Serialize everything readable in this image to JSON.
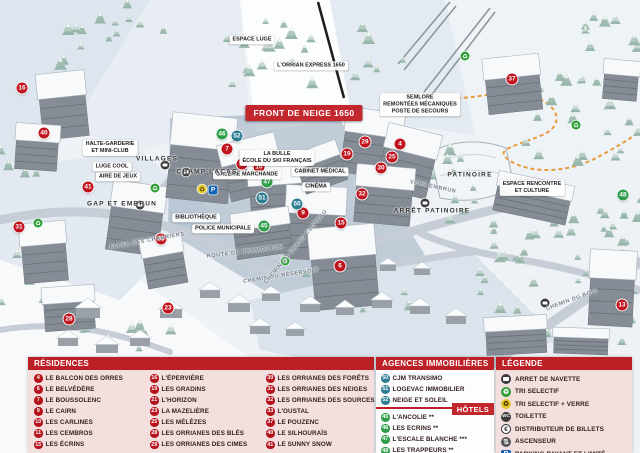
{
  "colors": {
    "header_red": "#bc1f26",
    "banner_red": "#c1272d",
    "residence_marker": "#c0151f",
    "hotel_marker": "#2f9e4a",
    "agency_marker": "#2e7d92",
    "panel_pink": "#f4dfdf"
  },
  "map": {
    "markers": [
      {
        "n": "16",
        "type": "residence",
        "x": 22,
        "y": 88
      },
      {
        "n": "40",
        "type": "residence",
        "x": 44,
        "y": 133
      },
      {
        "n": "31",
        "type": "residence",
        "x": 19,
        "y": 227
      },
      {
        "n": "41",
        "type": "residence",
        "x": 88,
        "y": 187
      },
      {
        "n": "33",
        "type": "residence",
        "x": 161,
        "y": 239
      },
      {
        "n": "28",
        "type": "residence",
        "x": 69,
        "y": 319
      },
      {
        "n": "23",
        "type": "residence",
        "x": 168,
        "y": 308
      },
      {
        "n": "7",
        "type": "residence",
        "x": 227,
        "y": 149
      },
      {
        "n": "11",
        "type": "residence",
        "x": 242,
        "y": 164
      },
      {
        "n": "10",
        "type": "residence",
        "x": 259,
        "y": 167
      },
      {
        "n": "19",
        "type": "residence",
        "x": 347,
        "y": 154
      },
      {
        "n": "9",
        "type": "residence",
        "x": 303,
        "y": 213
      },
      {
        "n": "15",
        "type": "residence",
        "x": 341,
        "y": 223
      },
      {
        "n": "6",
        "type": "residence",
        "x": 340,
        "y": 266
      },
      {
        "n": "29",
        "type": "residence",
        "x": 365,
        "y": 142
      },
      {
        "n": "4",
        "type": "residence",
        "x": 400,
        "y": 144
      },
      {
        "n": "25",
        "type": "residence",
        "x": 392,
        "y": 157
      },
      {
        "n": "30",
        "type": "residence",
        "x": 381,
        "y": 168
      },
      {
        "n": "32",
        "type": "residence",
        "x": 362,
        "y": 194
      },
      {
        "n": "37",
        "type": "residence",
        "x": 512,
        "y": 79
      },
      {
        "n": "13",
        "type": "residence",
        "x": 622,
        "y": 305
      },
      {
        "n": "46",
        "type": "hotel",
        "x": 222,
        "y": 134
      },
      {
        "n": "47",
        "type": "hotel",
        "x": 267,
        "y": 182
      },
      {
        "n": "45",
        "type": "hotel",
        "x": 264,
        "y": 226
      },
      {
        "n": "48",
        "type": "hotel",
        "x": 623,
        "y": 195
      },
      {
        "n": "52",
        "type": "agency",
        "x": 237,
        "y": 136
      },
      {
        "n": "51",
        "type": "agency",
        "x": 262,
        "y": 198
      },
      {
        "n": "50",
        "type": "agency",
        "x": 297,
        "y": 204
      }
    ],
    "icons": [
      {
        "type": "bus",
        "x": 165,
        "y": 165
      },
      {
        "type": "bus",
        "x": 186,
        "y": 172
      },
      {
        "type": "bus",
        "x": 140,
        "y": 205
      },
      {
        "type": "bus",
        "x": 425,
        "y": 203
      },
      {
        "type": "bus",
        "x": 545,
        "y": 303
      },
      {
        "type": "recycle",
        "x": 155,
        "y": 188
      },
      {
        "type": "recycle",
        "x": 38,
        "y": 223
      },
      {
        "type": "recycle",
        "x": 285,
        "y": 261
      },
      {
        "type": "recycle",
        "x": 576,
        "y": 125
      },
      {
        "type": "recycle",
        "x": 465,
        "y": 56
      },
      {
        "type": "recycle_glass",
        "x": 202,
        "y": 189
      },
      {
        "type": "parking",
        "x": 213,
        "y": 190
      }
    ],
    "labels": [
      {
        "text": "FRONT DE NEIGE 1650",
        "x": 304,
        "y": 113,
        "style": "banner",
        "rot": 0
      },
      {
        "text": "L'ORRIAN EXPRESS 1650",
        "x": 311,
        "y": 66,
        "style": "pill",
        "rot": 0
      },
      {
        "text": "ESPACE LUGE",
        "x": 252,
        "y": 40,
        "style": "pill",
        "rot": 0
      },
      {
        "text": "SEMLORE\nREMONTÉES MÉCANIQUES\nPOSTE DE SECOURS",
        "x": 420,
        "y": 105,
        "style": "pill",
        "rot": 0
      },
      {
        "text": "LA BULLE\nÉCOLE DU SKI FRANÇAIS",
        "x": 277,
        "y": 158,
        "style": "pill",
        "rot": 0
      },
      {
        "text": "GALERIE MARCHANDE",
        "x": 247,
        "y": 175,
        "style": "pill",
        "rot": 0
      },
      {
        "text": "CABINET MÉDICAL",
        "x": 320,
        "y": 172,
        "style": "pill",
        "rot": 0
      },
      {
        "text": "CINÉMA",
        "x": 316,
        "y": 187,
        "style": "pill",
        "rot": 0
      },
      {
        "text": "BIBLIOTHÈQUE",
        "x": 196,
        "y": 218,
        "style": "pill",
        "rot": 0
      },
      {
        "text": "POLICE MUNICIPALE",
        "x": 223,
        "y": 229,
        "style": "pill",
        "rot": 0
      },
      {
        "text": "HALTE-GARDERIE\nET MINI-CLUB",
        "x": 110,
        "y": 148,
        "style": "pill",
        "rot": 0
      },
      {
        "text": "LUGE COOL",
        "x": 112,
        "y": 167,
        "style": "pill",
        "rot": 0
      },
      {
        "text": "AIRE DE JEUX",
        "x": 118,
        "y": 177,
        "style": "pill",
        "rot": 0
      },
      {
        "text": "ESPACE RENCONTRE\nET CULTURE",
        "x": 532,
        "y": 188,
        "style": "pill",
        "rot": 0
      },
      {
        "text": "VILLAGES",
        "x": 157,
        "y": 159,
        "style": "plain",
        "rot": 0
      },
      {
        "text": "CHAMP LACAS",
        "x": 207,
        "y": 172,
        "style": "plain",
        "rot": 0
      },
      {
        "text": "GAP ET EMBRUN",
        "x": 122,
        "y": 204,
        "style": "plain",
        "rot": 0
      },
      {
        "text": "ARRÊT PATINOIRE",
        "x": 432,
        "y": 211,
        "style": "plain",
        "rot": 0
      },
      {
        "text": "PATINOIRE",
        "x": 470,
        "y": 175,
        "style": "plain",
        "rot": 0
      },
      {
        "text": "ROUTE DE PRAMOUTON",
        "x": 245,
        "y": 252,
        "style": "road",
        "rot": -7
      },
      {
        "text": "CHEMIN DU RÉSERVOIR",
        "x": 281,
        "y": 276,
        "style": "road",
        "rot": -9
      },
      {
        "text": "ALLÉE DES CHABRIERS",
        "x": 147,
        "y": 241,
        "style": "road",
        "rot": -10
      },
      {
        "text": "CHEMIN DU GRAND CLOTEAU",
        "x": 296,
        "y": 247,
        "style": "road",
        "rot": -50
      },
      {
        "text": "VERS EMBRUN",
        "x": 433,
        "y": 187,
        "style": "road",
        "rot": 12
      },
      {
        "text": "CHEMIN DU BOIS",
        "x": 572,
        "y": 300,
        "style": "road",
        "rot": -20
      }
    ]
  },
  "legend_panel": {
    "residences": {
      "title": "RÉSIDENCES",
      "items": [
        {
          "n": "4",
          "label": "LE BALCON DES ORRES"
        },
        {
          "n": "6",
          "label": "LE BELVÉDÈRE"
        },
        {
          "n": "7",
          "label": "LE BOUSSOLENC"
        },
        {
          "n": "9",
          "label": "LE CAIRN"
        },
        {
          "n": "10",
          "label": "LES CARLINES"
        },
        {
          "n": "11",
          "label": "LES CEMBROS"
        },
        {
          "n": "15",
          "label": "LES ÉCRINS"
        },
        {
          "n": "16",
          "label": "L'ÉPERVIÈRE"
        },
        {
          "n": "19",
          "label": "LES GRADINS"
        },
        {
          "n": "21",
          "label": "L'HORIZON"
        },
        {
          "n": "23",
          "label": "LA MAZELIÈRE"
        },
        {
          "n": "25",
          "label": "LES MÉLÈZES"
        },
        {
          "n": "28",
          "label": "LES ORRIANES DES BLÉS"
        },
        {
          "n": "29",
          "label": "LES ORRIANES DES CIMES"
        },
        {
          "n": "30",
          "label": "LES ORRIANES DES FORÊTS"
        },
        {
          "n": "31",
          "label": "LES ORRIANES DES NEIGES"
        },
        {
          "n": "32",
          "label": "LES ORRIANES DES SOURCES"
        },
        {
          "n": "33",
          "label": "L'OUSTAL"
        },
        {
          "n": "37",
          "label": "LE POUZENC"
        },
        {
          "n": "40",
          "label": "LE SILHOURAÏS"
        },
        {
          "n": "41",
          "label": "LE SUNNY SNOW"
        }
      ]
    },
    "agencies": {
      "title": "AGENCES IMMOBILIÈRES",
      "items": [
        {
          "n": "50",
          "label": "CJM TRANSIMO"
        },
        {
          "n": "51",
          "label": "LOGEVAC IMMOBILIER"
        },
        {
          "n": "52",
          "label": "NEIGE ET SOLEIL"
        }
      ]
    },
    "hotels": {
      "title": "HÔTELS",
      "items": [
        {
          "n": "45",
          "label": "L'ANCOLIE **"
        },
        {
          "n": "46",
          "label": "LES ECRINS **"
        },
        {
          "n": "47",
          "label": "L'ESCALE BLANCHE ***"
        },
        {
          "n": "48",
          "label": "LES TRAPPEURS **"
        }
      ]
    },
    "key": {
      "title": "LÉGENDE",
      "items": [
        {
          "icon": "bus",
          "label": "ARRET DE NAVETTE"
        },
        {
          "icon": "recycle",
          "label": "TRI SELECTIF"
        },
        {
          "icon": "recycle_glass",
          "label": "TRI SELECTIF + VERRE"
        },
        {
          "icon": "wc",
          "label": "TOILETTE"
        },
        {
          "icon": "euro",
          "label": "DISTRIBUTEUR DE BILLETS"
        },
        {
          "icon": "lift",
          "label": "ASCENSEUR"
        },
        {
          "icon": "parking",
          "label": "PARKING PAYANT ET LIMITÉ"
        }
      ]
    }
  }
}
